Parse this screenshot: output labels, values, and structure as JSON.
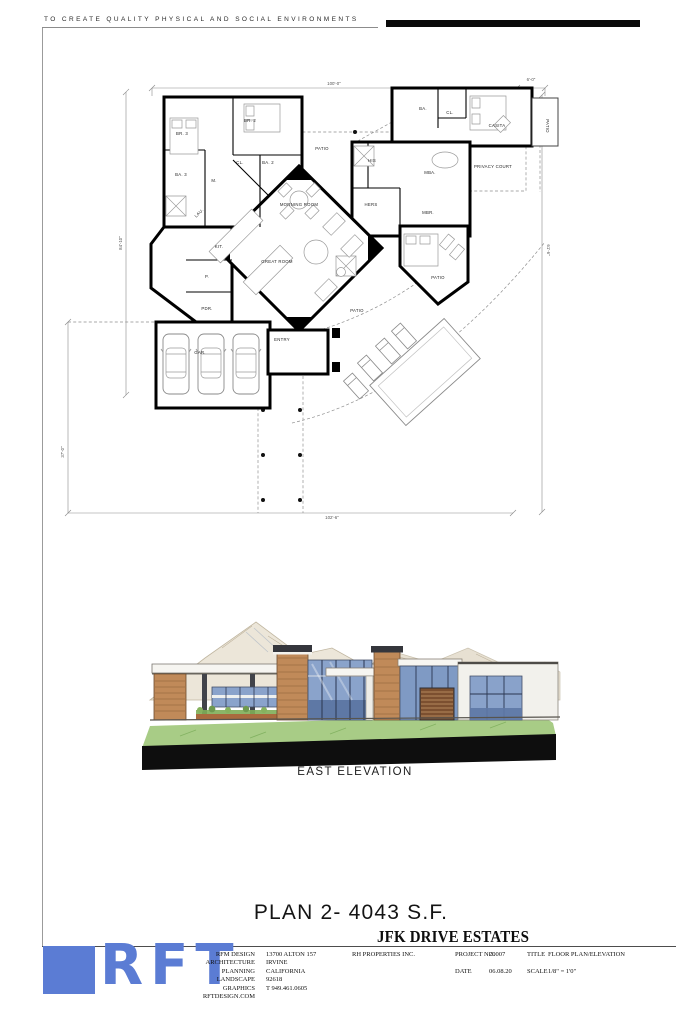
{
  "sheet": {
    "motto": "TO CREATE QUALITY PHYSICAL AND SOCIAL ENVIRONMENTS",
    "plan_title": "PLAN 2- 4043 S.F.",
    "project_name": "JFK DRIVE ESTATES",
    "elevation_label": "EAST ELEVATION"
  },
  "plan": {
    "rooms": [
      {
        "label": "BR. 3"
      },
      {
        "label": "BR. 2"
      },
      {
        "label": "BA. 3"
      },
      {
        "label": "CL."
      },
      {
        "label": "BA. 2"
      },
      {
        "label": "M."
      },
      {
        "label": "LAU."
      },
      {
        "label": "KIT."
      },
      {
        "label": "MORNING ROOM"
      },
      {
        "label": "GREAT ROOM"
      },
      {
        "label": "P."
      },
      {
        "label": "PDR."
      },
      {
        "label": "ENTRY"
      },
      {
        "label": "GAR."
      },
      {
        "label": "BA."
      },
      {
        "label": "CL."
      },
      {
        "label": "CASITA"
      },
      {
        "label": "PATIO"
      },
      {
        "label": "MBA."
      },
      {
        "label": "PRIVACY COURT"
      },
      {
        "label": "HIS"
      },
      {
        "label": "HERS"
      },
      {
        "label": "MBR."
      },
      {
        "label": "PATIO"
      },
      {
        "label": "PATIO"
      },
      {
        "label": "PATIO"
      }
    ],
    "dims": [
      {
        "label": "100'-0\""
      },
      {
        "label": "6'-0\""
      },
      {
        "label": "84'-10\""
      },
      {
        "label": "37'-0\""
      },
      {
        "label": "102'-6\""
      },
      {
        "label": "61'-6\""
      }
    ]
  },
  "title_block": {
    "logo_text": "RFT",
    "firm": [
      "RFM DESIGN",
      "ARCHITECTURE",
      "PLANNING",
      "LANDSCAPE",
      "GRAPHICS",
      "RFTDESIGN.COM"
    ],
    "address": [
      "13700 ALTON 157",
      "IRVINE",
      "CALIFORNIA",
      "92618",
      "T 949.461.0605"
    ],
    "client": "RH PROPERTIES INC.",
    "fields": [
      {
        "label": "PROJECT NO.",
        "value": "20007"
      },
      {
        "label": "DATE",
        "value": "06.08.20"
      },
      {
        "label": "TITLE",
        "value": "FLOOR PLAN/ELEVATION"
      },
      {
        "label": "SCALE",
        "value": "1/8\" = 1'0\""
      }
    ]
  },
  "colors": {
    "logo_blue": "#5b7cd4",
    "glass_blue": "#8aa3cb",
    "glass_blue_dark": "#5e78a5",
    "wood_tan": "#c08a59",
    "grass_green": "#a8cc86",
    "mountain_tan": "#e9e2d3",
    "base_black": "#0e0e0e"
  }
}
